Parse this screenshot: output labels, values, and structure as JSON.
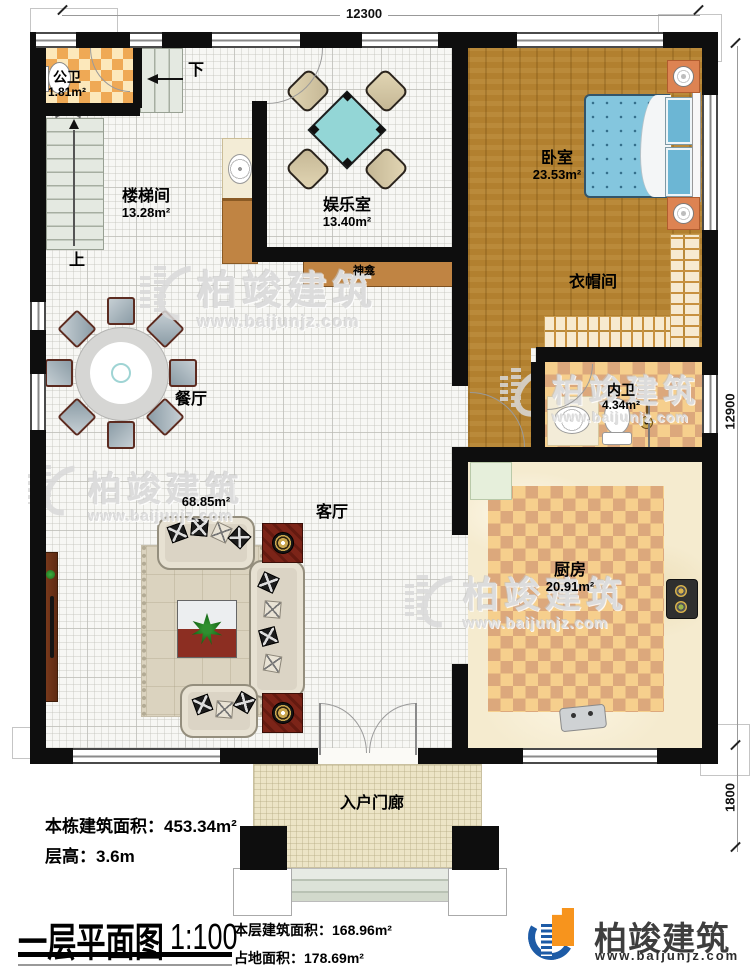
{
  "dimensions": {
    "top": "12300",
    "right": "12900",
    "porch": "1800"
  },
  "rooms": {
    "gongwei": {
      "name": "公卫",
      "area": "1.81m²"
    },
    "loutijian": {
      "name": "楼梯间",
      "area": "13.28m²"
    },
    "yuleshi": {
      "name": "娱乐室",
      "area": "13.40m²"
    },
    "woshi": {
      "name": "卧室",
      "area": "23.53m²"
    },
    "yimaojian": {
      "name": "衣帽间"
    },
    "neiwei": {
      "name": "内卫",
      "area": "4.34m²"
    },
    "canting": {
      "name": "餐厅"
    },
    "keting": {
      "name": "客厅",
      "area": "68.85m²"
    },
    "chufang": {
      "name": "厨房",
      "area": "20.91m²"
    },
    "rumenlang": {
      "name": "入户门廊"
    },
    "shenkan": {
      "name": "神龛"
    }
  },
  "stairs": {
    "up": "上",
    "down": "下"
  },
  "info": {
    "building_area_label": "本栋建筑面积：",
    "building_area_value": "453.34m²",
    "floor_height_label": "层高：",
    "floor_height_value": "3.6m"
  },
  "title_block": {
    "title": "一层平面图",
    "scale": "1:100",
    "floor_area_label": "本层建筑面积：",
    "floor_area_value": "168.96m²",
    "land_area_label": "占地面积：",
    "land_area_value": "178.69m²"
  },
  "brand": {
    "name": "柏竣建筑",
    "website": "www.baijunjz.com"
  },
  "watermark": {
    "name": "柏竣建筑",
    "website": "www.baijunjz.com"
  },
  "colors": {
    "wall": "#0e0e0e",
    "accent_blue": "#1d5ba6",
    "accent_orange": "#f7941d"
  }
}
